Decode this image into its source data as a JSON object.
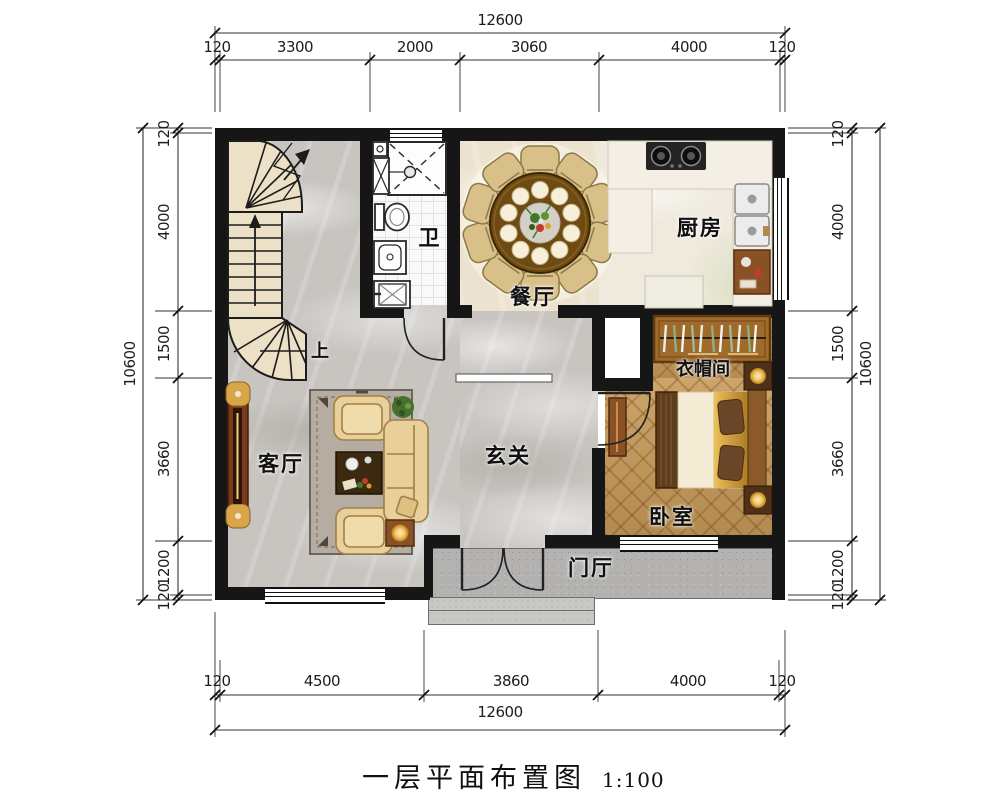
{
  "title": {
    "name": "一层平面布置图",
    "scale": "1:100"
  },
  "rooms": {
    "bathroom": "卫",
    "dining": "餐厅",
    "kitchen": "厨房",
    "cloakroom": "衣帽间",
    "bedroom": "卧室",
    "living": "客厅",
    "foyer": "玄关",
    "porch": "门厅"
  },
  "stairs": {
    "up_label": "上"
  },
  "dimensions": {
    "top": {
      "total": "12600",
      "segments": [
        "120",
        "3300",
        "2000",
        "3060",
        "4000",
        "120"
      ]
    },
    "bottom": {
      "total": "12600",
      "segments": [
        "120",
        "4500",
        "3860",
        "4000",
        "120"
      ]
    },
    "left": {
      "total": "10600",
      "segments": [
        "120",
        "4000",
        "1500",
        "3660",
        "1200",
        "120"
      ]
    },
    "right": {
      "total": "10600",
      "segments": [
        "120",
        "4000",
        "1500",
        "3660",
        "1200",
        "120"
      ]
    }
  },
  "colors": {
    "wall": "#161616",
    "marble_gray": "#c8c5c1",
    "marble_cream": "#ebe2d0",
    "wood_floor": "#c79a58",
    "granite": "#b4b2b0",
    "stair_fill": "#ece1c6",
    "sofa": "#e9cf99",
    "table_wood": "#6e4b12",
    "accent_gold": "#d9a54a"
  }
}
